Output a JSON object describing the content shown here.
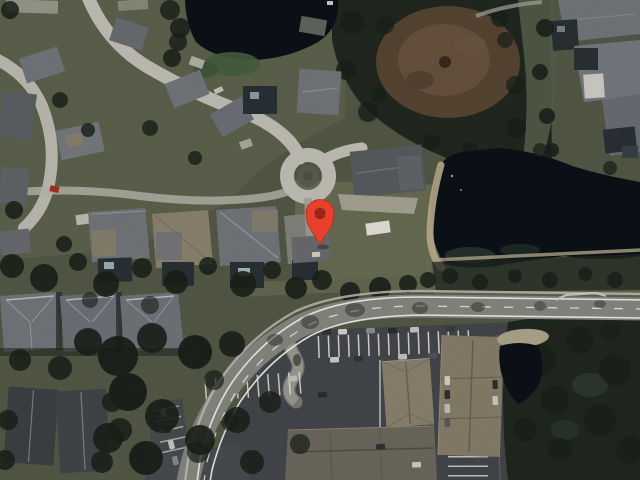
{
  "map": {
    "view": "satellite",
    "marker": {
      "type": "map-pin",
      "transform": "translate(320,245)",
      "tip_x": 320,
      "tip_y": 245,
      "color": "#E8402C",
      "dot_color": "#992715"
    },
    "palette": {
      "grass": "#565B48",
      "lawn": "#6E7157",
      "forest": "#222921",
      "tree": "#1A211A",
      "water": "#0C1218",
      "sand": "#C3B391",
      "scrub": "#5A4734",
      "scrubInner": "#6A5440",
      "street": "#C6C4BA",
      "road": "#8A8A84",
      "lot": "#45484C",
      "marking": "#F5F5F0",
      "roofGray": "#75787D",
      "roofDark": "#3E4246",
      "roofTan": "#8E8470",
      "concrete": "#B5B1A4",
      "gravel": "#B2A88E",
      "cage": "#2B3236",
      "marker": "#E8402C",
      "markerDot": "#992715"
    },
    "features": [
      "residential-neighborhood-northwest",
      "cul-de-sac",
      "pond-north",
      "lake-east",
      "dry-brush-patch-northeast",
      "tree-line-center",
      "main-road-east-west",
      "apartment-complex-south",
      "parking-lots-south",
      "forest-southeast",
      "small-pond-southeast",
      "townhouse-rows-southwest"
    ]
  }
}
